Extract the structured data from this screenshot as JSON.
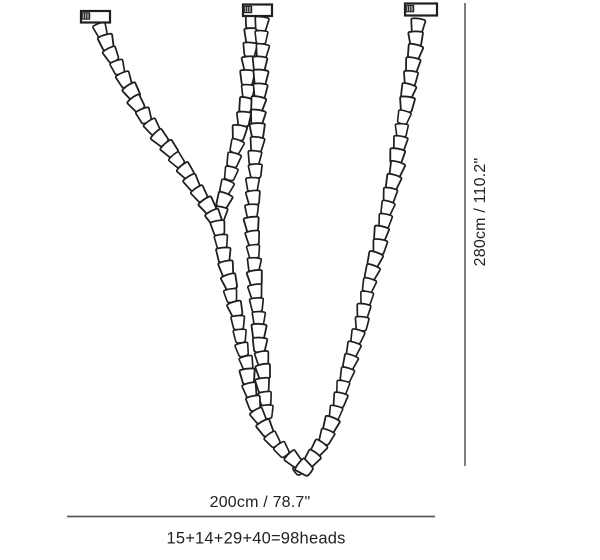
{
  "page": {
    "background": "#ffffff"
  },
  "diagram": {
    "type": "product-dimension-diagram",
    "labels": {
      "height_dimension": "280cm / 110.2\"",
      "width_dimension": "200cm / 78.7\"",
      "heads_formula": "15+14+29+40=98heads"
    },
    "measurements": {
      "height_cm": 280,
      "height_in": 110.2,
      "width_cm": 200,
      "width_in": 78.7,
      "heads_per_chain": [
        15,
        14,
        29,
        40
      ],
      "total_heads": 98,
      "canopy_count": 3,
      "chain_count": 4
    },
    "colors": {
      "ink": "#1f1f1f",
      "dimension_line": "#5a5a5a",
      "text": "#222222",
      "background": "#ffffff"
    }
  }
}
